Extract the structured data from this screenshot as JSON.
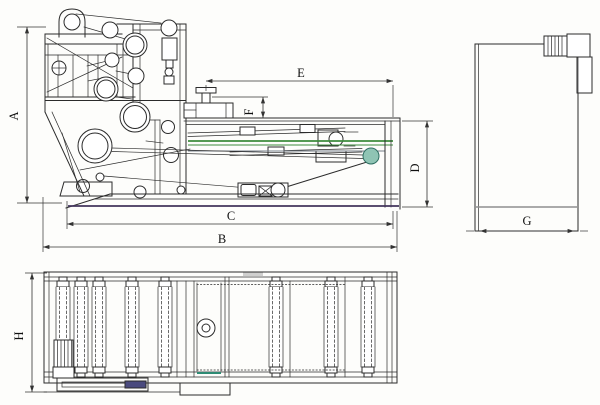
{
  "dims": {
    "A": "A",
    "B": "B",
    "C": "C",
    "D": "D",
    "E": "E",
    "F": "F",
    "G": "G",
    "H": "H"
  },
  "colors": {
    "line": "#2b2b2b",
    "dim_line": "#333333",
    "belt_green": "#3d8b3d",
    "belt_gray": "#77808a",
    "roller_teal_fill": "#8fc4b4",
    "base_purple": "#43355c",
    "end_view_gray": "#8f8f8f",
    "blue_bar": "#4a4a7e",
    "teal_bar": "#2e8b74",
    "paper": "#fdfdfb"
  }
}
